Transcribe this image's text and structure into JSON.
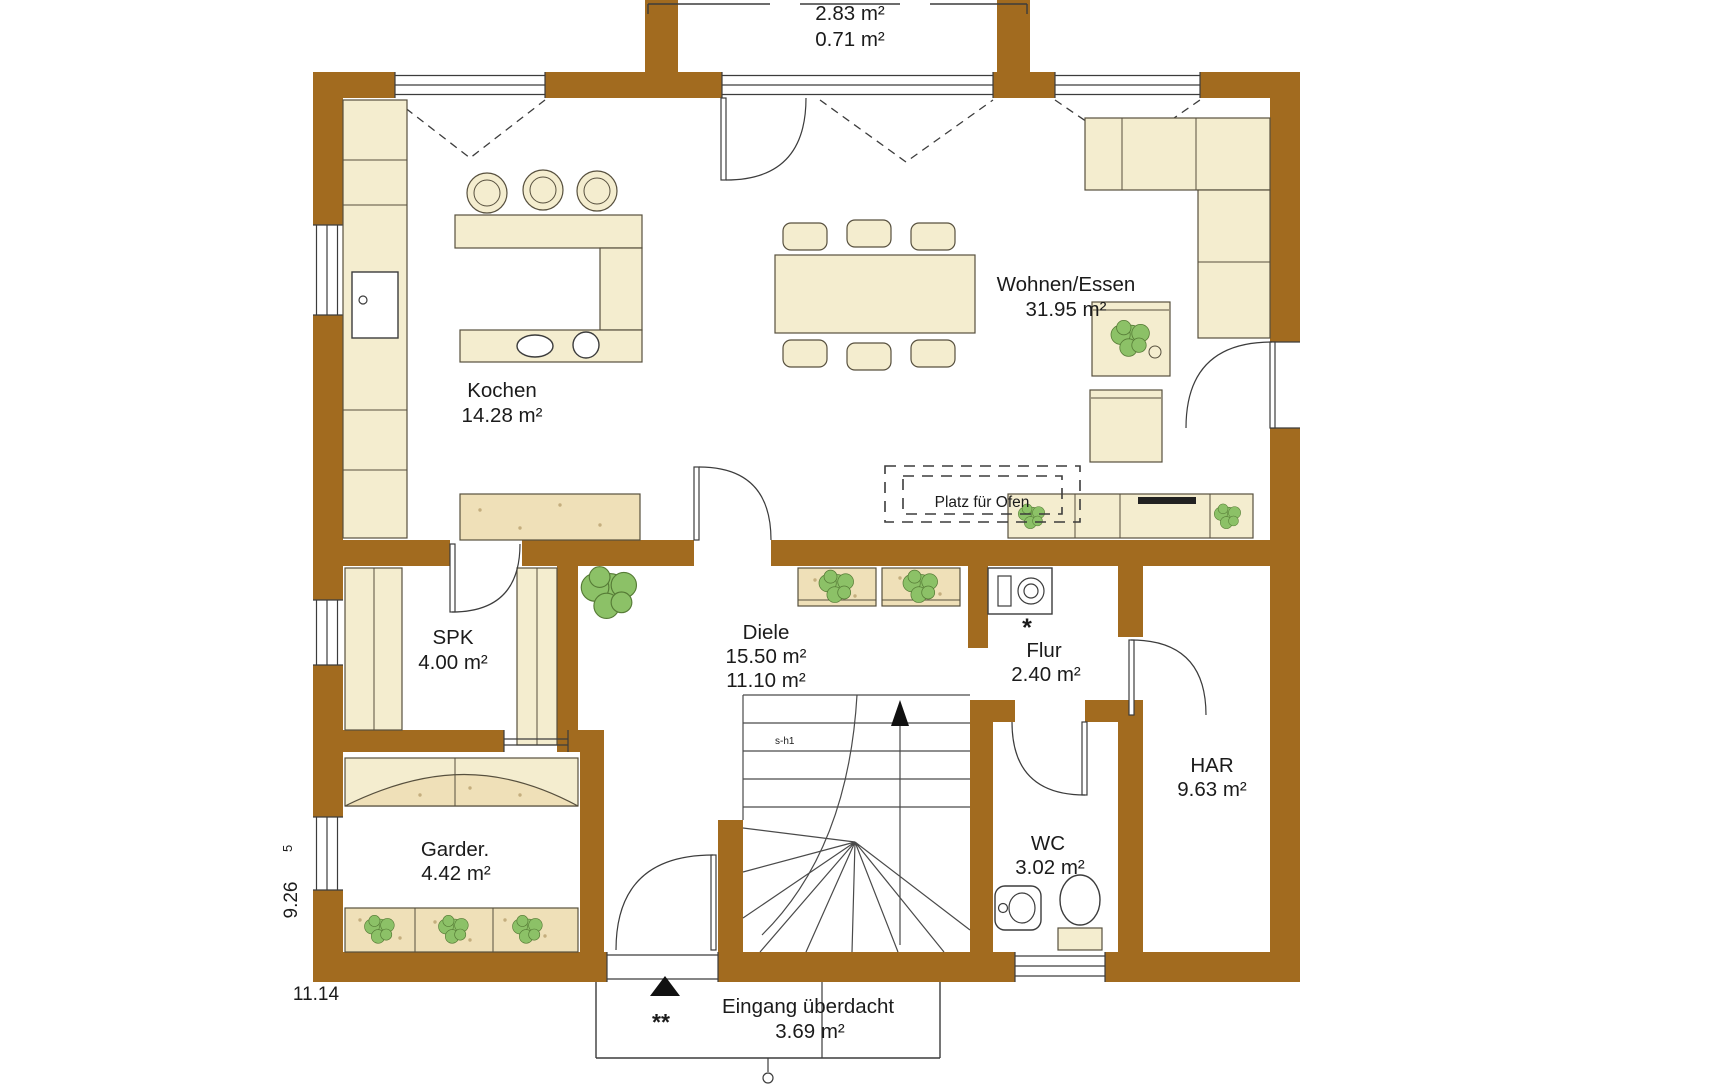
{
  "colors": {
    "wall": "#A26B1F",
    "furniture_cream": "#F4EDCF",
    "furniture_tan": "#EFE0B8",
    "plant_green": "#8CC167",
    "plant_stroke": "#567B36",
    "line_dark": "#3C3C3C",
    "accent_red": "#CC1F1F",
    "floor_white": "#FFFFFF"
  },
  "rooms": {
    "top_terrace": {
      "area1": "2.83 m²",
      "area2": "0.71 m²"
    },
    "wohnen_essen": {
      "name": "Wohnen/Essen",
      "area": "31.95 m²"
    },
    "kochen": {
      "name": "Kochen",
      "area": "14.28 m²"
    },
    "spk": {
      "name": "SPK",
      "area": "4.00 m²"
    },
    "diele": {
      "name": "Diele",
      "area1": "15.50 m²",
      "area2": "11.10 m²"
    },
    "flur": {
      "name": "Flur",
      "area": "2.40 m²"
    },
    "har": {
      "name": "HAR",
      "area": "9.63 m²"
    },
    "garderobe": {
      "name": "Garder.",
      "area": "4.42 m²"
    },
    "wc": {
      "name": "WC",
      "area": "3.02 m²"
    },
    "eingang": {
      "name": "Eingang überdacht",
      "area": "3.69 m²"
    }
  },
  "annotations": {
    "platz_fuer_ofen": "Platz für Ofen",
    "stair_code": "s-h1",
    "flur_marker": "*",
    "eingang_marker": "**"
  },
  "dimensions": {
    "height_m": "9.26",
    "height_sub": "5",
    "width_m": "11.14"
  }
}
